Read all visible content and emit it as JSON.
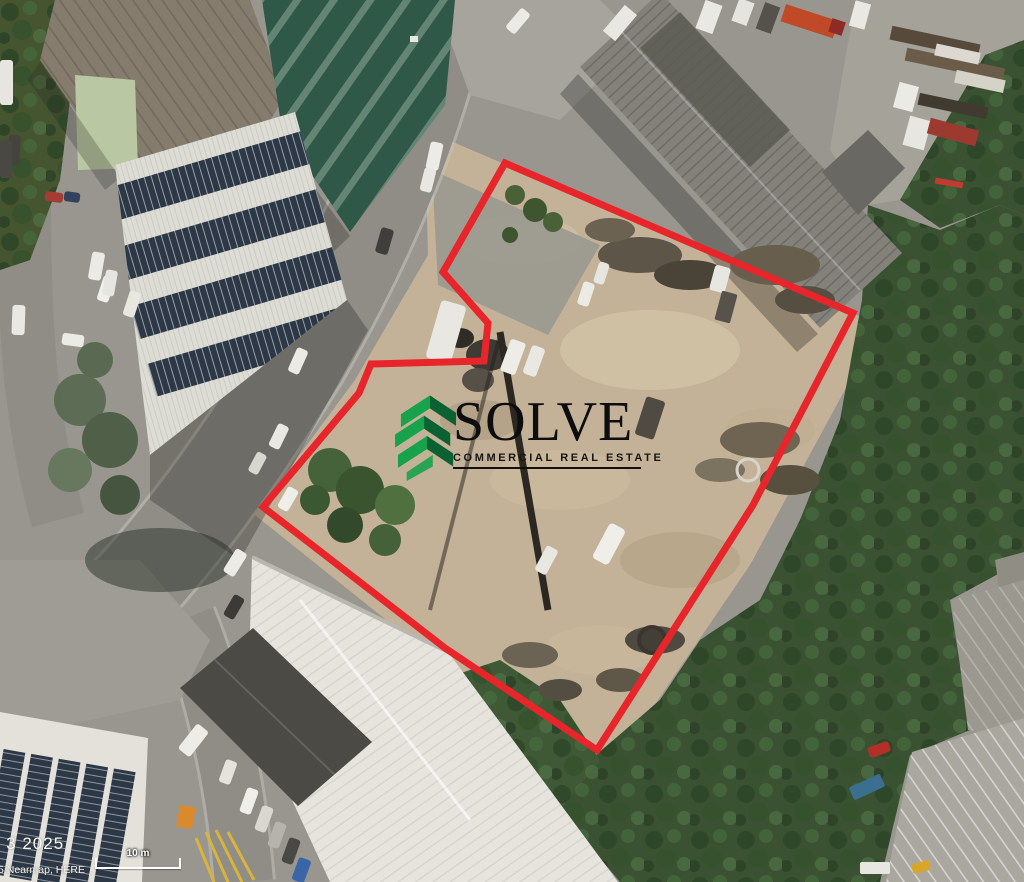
{
  "map": {
    "attribution_date": "– 3 2025",
    "attribution_credit": "5 Nearmap, HERE",
    "scale_bar": {
      "label": "10 m"
    }
  },
  "logo": {
    "brand": "SOLVE",
    "tagline": "COMMERCIAL REAL ESTATE"
  },
  "colors": {
    "boundary_red": "#e8252a",
    "logo_green": "#18a24c",
    "logo_green_dark": "#0c6132",
    "logo_text": "#0d0d0d",
    "attribution_text": "#f5f5f0"
  },
  "icons": {
    "logo_icon": "solve-chevron-s-icon"
  }
}
